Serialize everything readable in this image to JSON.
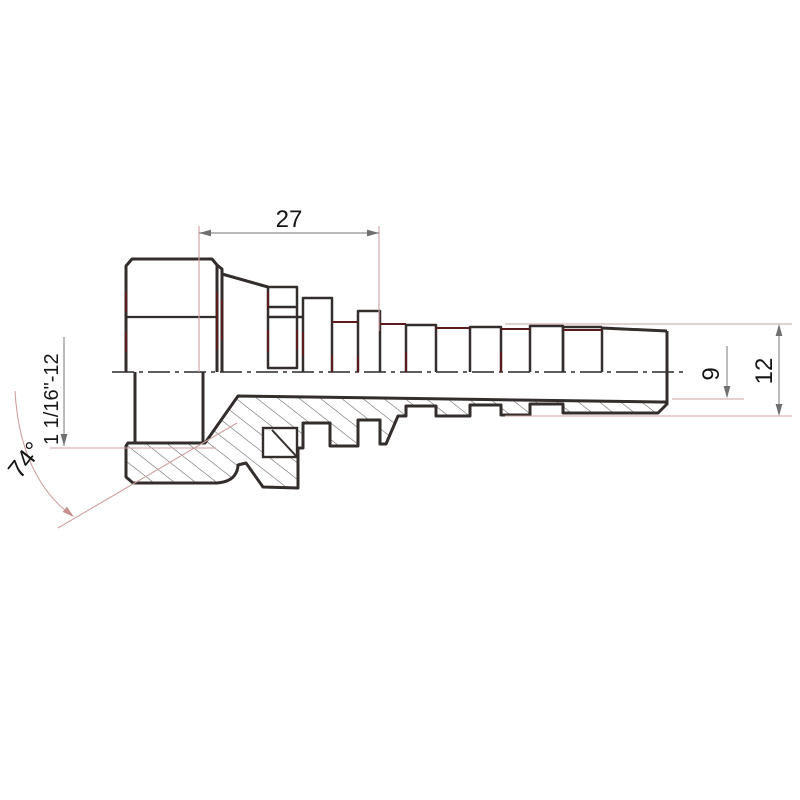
{
  "drawing_labels": {
    "length": "27",
    "thread": "1 1/16\"-12",
    "angle": "74°",
    "inner_diameter": "9",
    "outer_diameter": "12"
  },
  "colors": {
    "outline": "#332d2b",
    "accent_maroon": "#5c1a1a",
    "extension_pink": "#cfa0a0",
    "dimension_gray": "#8f8f8f",
    "hatch": "#5f5f5f",
    "text": "#161616",
    "background": "#ffffff"
  }
}
